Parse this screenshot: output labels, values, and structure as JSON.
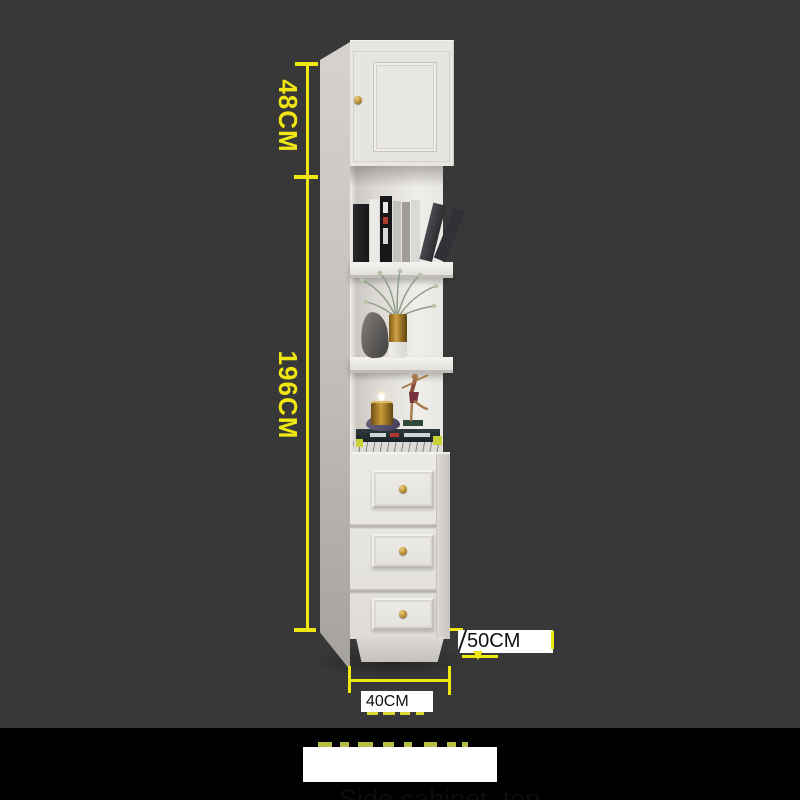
{
  "scene": {
    "background_color": "#383838",
    "bottom_band_color": "#000000"
  },
  "dimensions": {
    "accent_color": "#f0e612",
    "label_box_bg": "#ffffff",
    "label_text_color": "#111111",
    "top_section_height": {
      "label": "48CM"
    },
    "lower_section_height": {
      "label": "196CM"
    },
    "depth": {
      "label": "50CM"
    },
    "width": {
      "label": "40CM"
    }
  },
  "caption": {
    "text": "Side cabinet  top",
    "bg": "#ffffff",
    "text_color": "#0d0d0d"
  },
  "cabinet": {
    "body_color": "#e8e6e1",
    "knob_color": "#b68a2e",
    "decor_items": [
      "books",
      "leaning-books",
      "plant",
      "brass-vase",
      "torso-sculpture",
      "dancer-figurine",
      "candle",
      "stacked-books"
    ]
  }
}
